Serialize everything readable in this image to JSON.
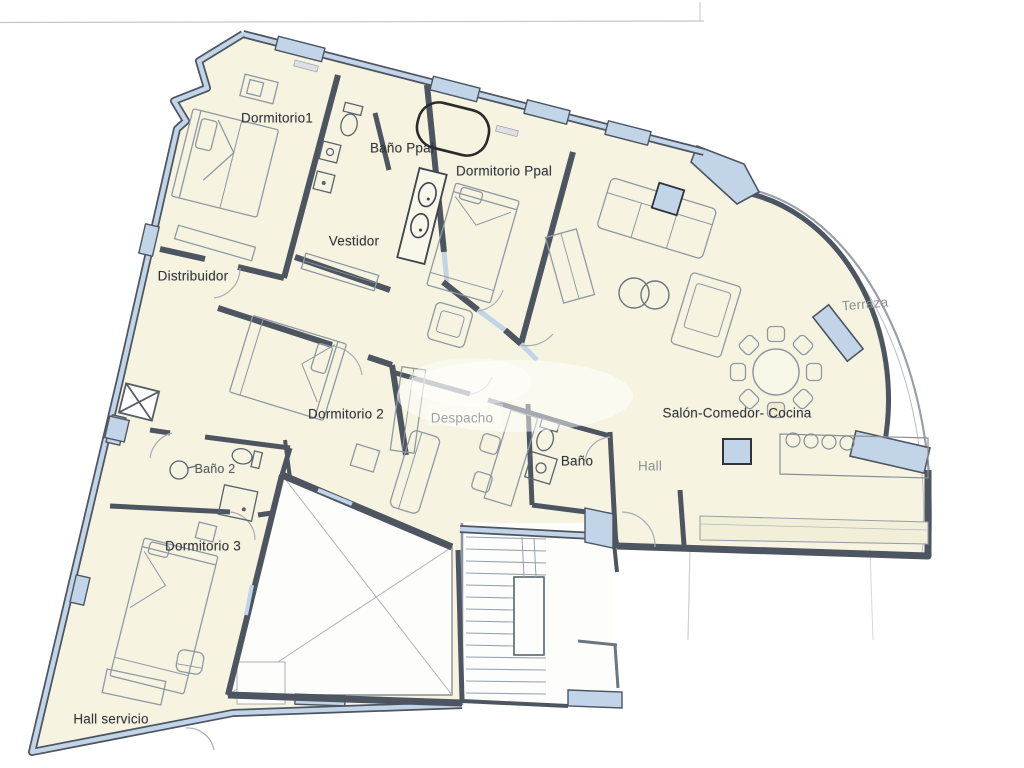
{
  "document_type": "apartment floor plan (scanned)",
  "rooms": {
    "dormitorio1": {
      "label": "Dormitorio1"
    },
    "bano_ppal": {
      "label": "Baño Ppal"
    },
    "dormitorio_ppal": {
      "label": "Dormitorio Ppal"
    },
    "vestidor": {
      "label": "Vestidor"
    },
    "distribuidor": {
      "label": "Distribuidor"
    },
    "dormitorio_2": {
      "label": "Dormitorio 2"
    },
    "bano_2": {
      "label": "Baño 2"
    },
    "despacho": {
      "label": "Despacho"
    },
    "bano": {
      "label": "Baño"
    },
    "hall": {
      "label": "Hall"
    },
    "salon": {
      "label": "Salón-Comedor- Cocina"
    },
    "terraza": {
      "label": "Terraza"
    },
    "dormitorio_3": {
      "label": "Dormitorio 3"
    },
    "hall_servicio": {
      "label": "Hall servicio"
    }
  },
  "colors": {
    "wall_fill_blue": "#c2d4e8",
    "wall_outline": "#4d5560",
    "floor_cream": "#f6f4e1",
    "counter_cream": "#f2efd8",
    "furniture_line": "#8f98a3",
    "label_text": "#35353a",
    "label_text_light": "#8d9096"
  }
}
